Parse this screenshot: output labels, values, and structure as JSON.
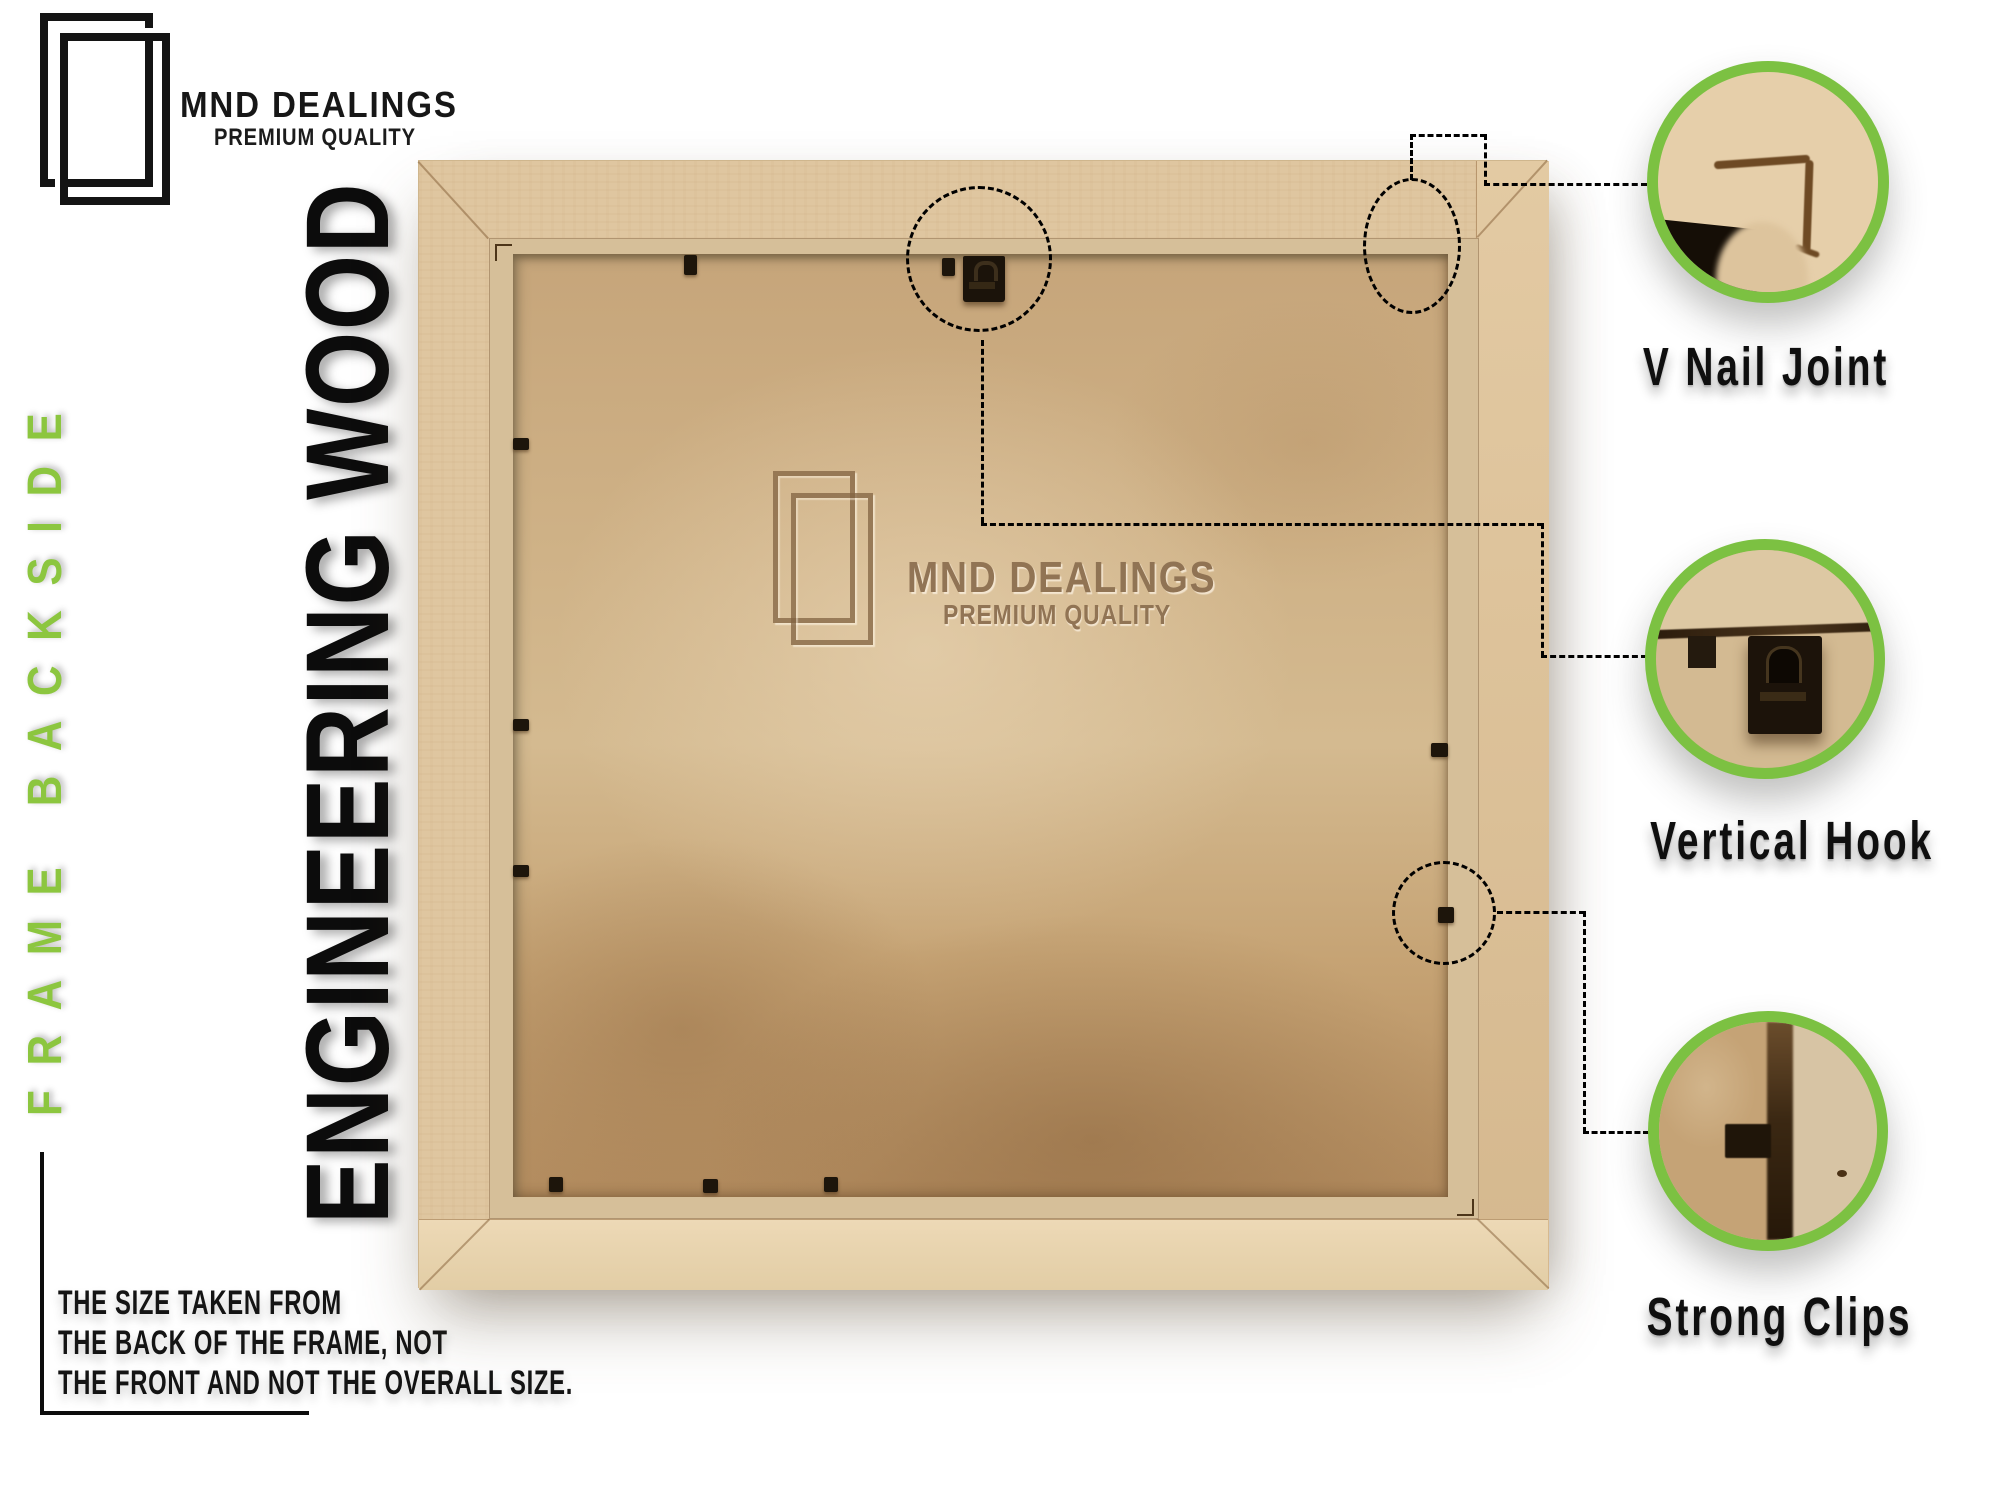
{
  "brand": {
    "name": "MND DEALINGS",
    "tagline": "PREMIUM QUALITY"
  },
  "side_labels": {
    "green": "FRAME BACKSIDE",
    "black": "ENGINEERING WOOD"
  },
  "watermark": {
    "name": "MND DEALINGS",
    "tagline": "PREMIUM QUALITY"
  },
  "callouts": [
    {
      "id": "v-nail-joint",
      "label": "V Nail Joint"
    },
    {
      "id": "vertical-hook",
      "label": "Vertical Hook"
    },
    {
      "id": "strong-clips",
      "label": "Strong Clips"
    }
  ],
  "note": {
    "lines": [
      "THE SIZE TAKEN FROM",
      "THE BACK OF THE FRAME, NOT",
      "THE FRONT AND NOT THE OVERALL SIZE."
    ]
  },
  "colors": {
    "accent_green": "#7cc142",
    "green_text": "#8cc63f",
    "label_black": "#0f0f0f",
    "wood": "#dfc6a0",
    "backing_tan": "#c9aa7f"
  }
}
